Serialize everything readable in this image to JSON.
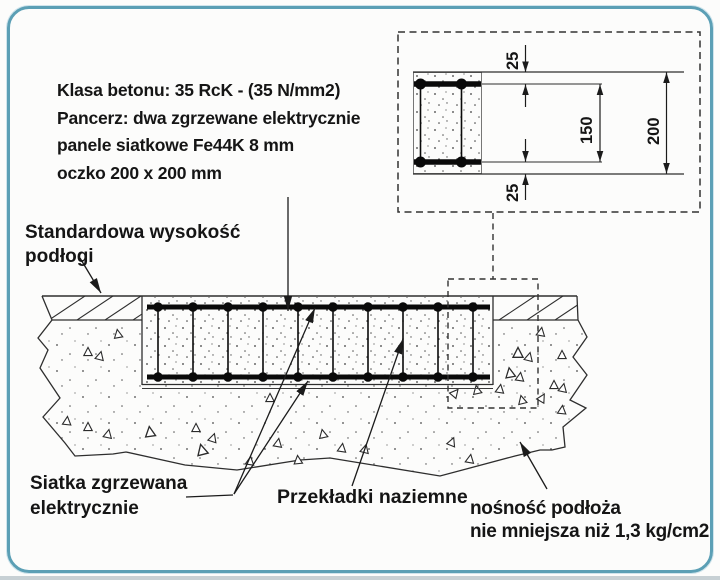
{
  "colors": {
    "frame_border": "#5b9fb5",
    "drawing_ink": "#2e2e2e",
    "mesh_ink": "#0a0a0a",
    "bottom_strip": "#c7d0d4"
  },
  "spec_block": {
    "lines": [
      "Klasa betonu: 35 RcK - (35 N/mm2)",
      "Pancerz: dwa zgrzewane elektrycznie",
      "panele siatkowe Fe44K 8 mm",
      "oczko 200 x 200 mm"
    ]
  },
  "callout_labels": {
    "floor_height": {
      "lines": [
        "Standardowa wysokość",
        "podłogi"
      ]
    },
    "welded_mesh": {
      "lines": [
        "Siatka zgrzewana",
        "elektrycznie"
      ]
    },
    "ground_spacers": {
      "text": "Przekładki naziemne"
    },
    "subgrade_capacity": {
      "lines": [
        "nośność podłoża",
        "nie mniejsza niż 1,3 kg/cm2"
      ]
    }
  },
  "detail_view": {
    "dims": {
      "cover_top": "25",
      "mesh_spacing": "150",
      "slab_thickness": "200",
      "cover_bottom": "25"
    }
  }
}
